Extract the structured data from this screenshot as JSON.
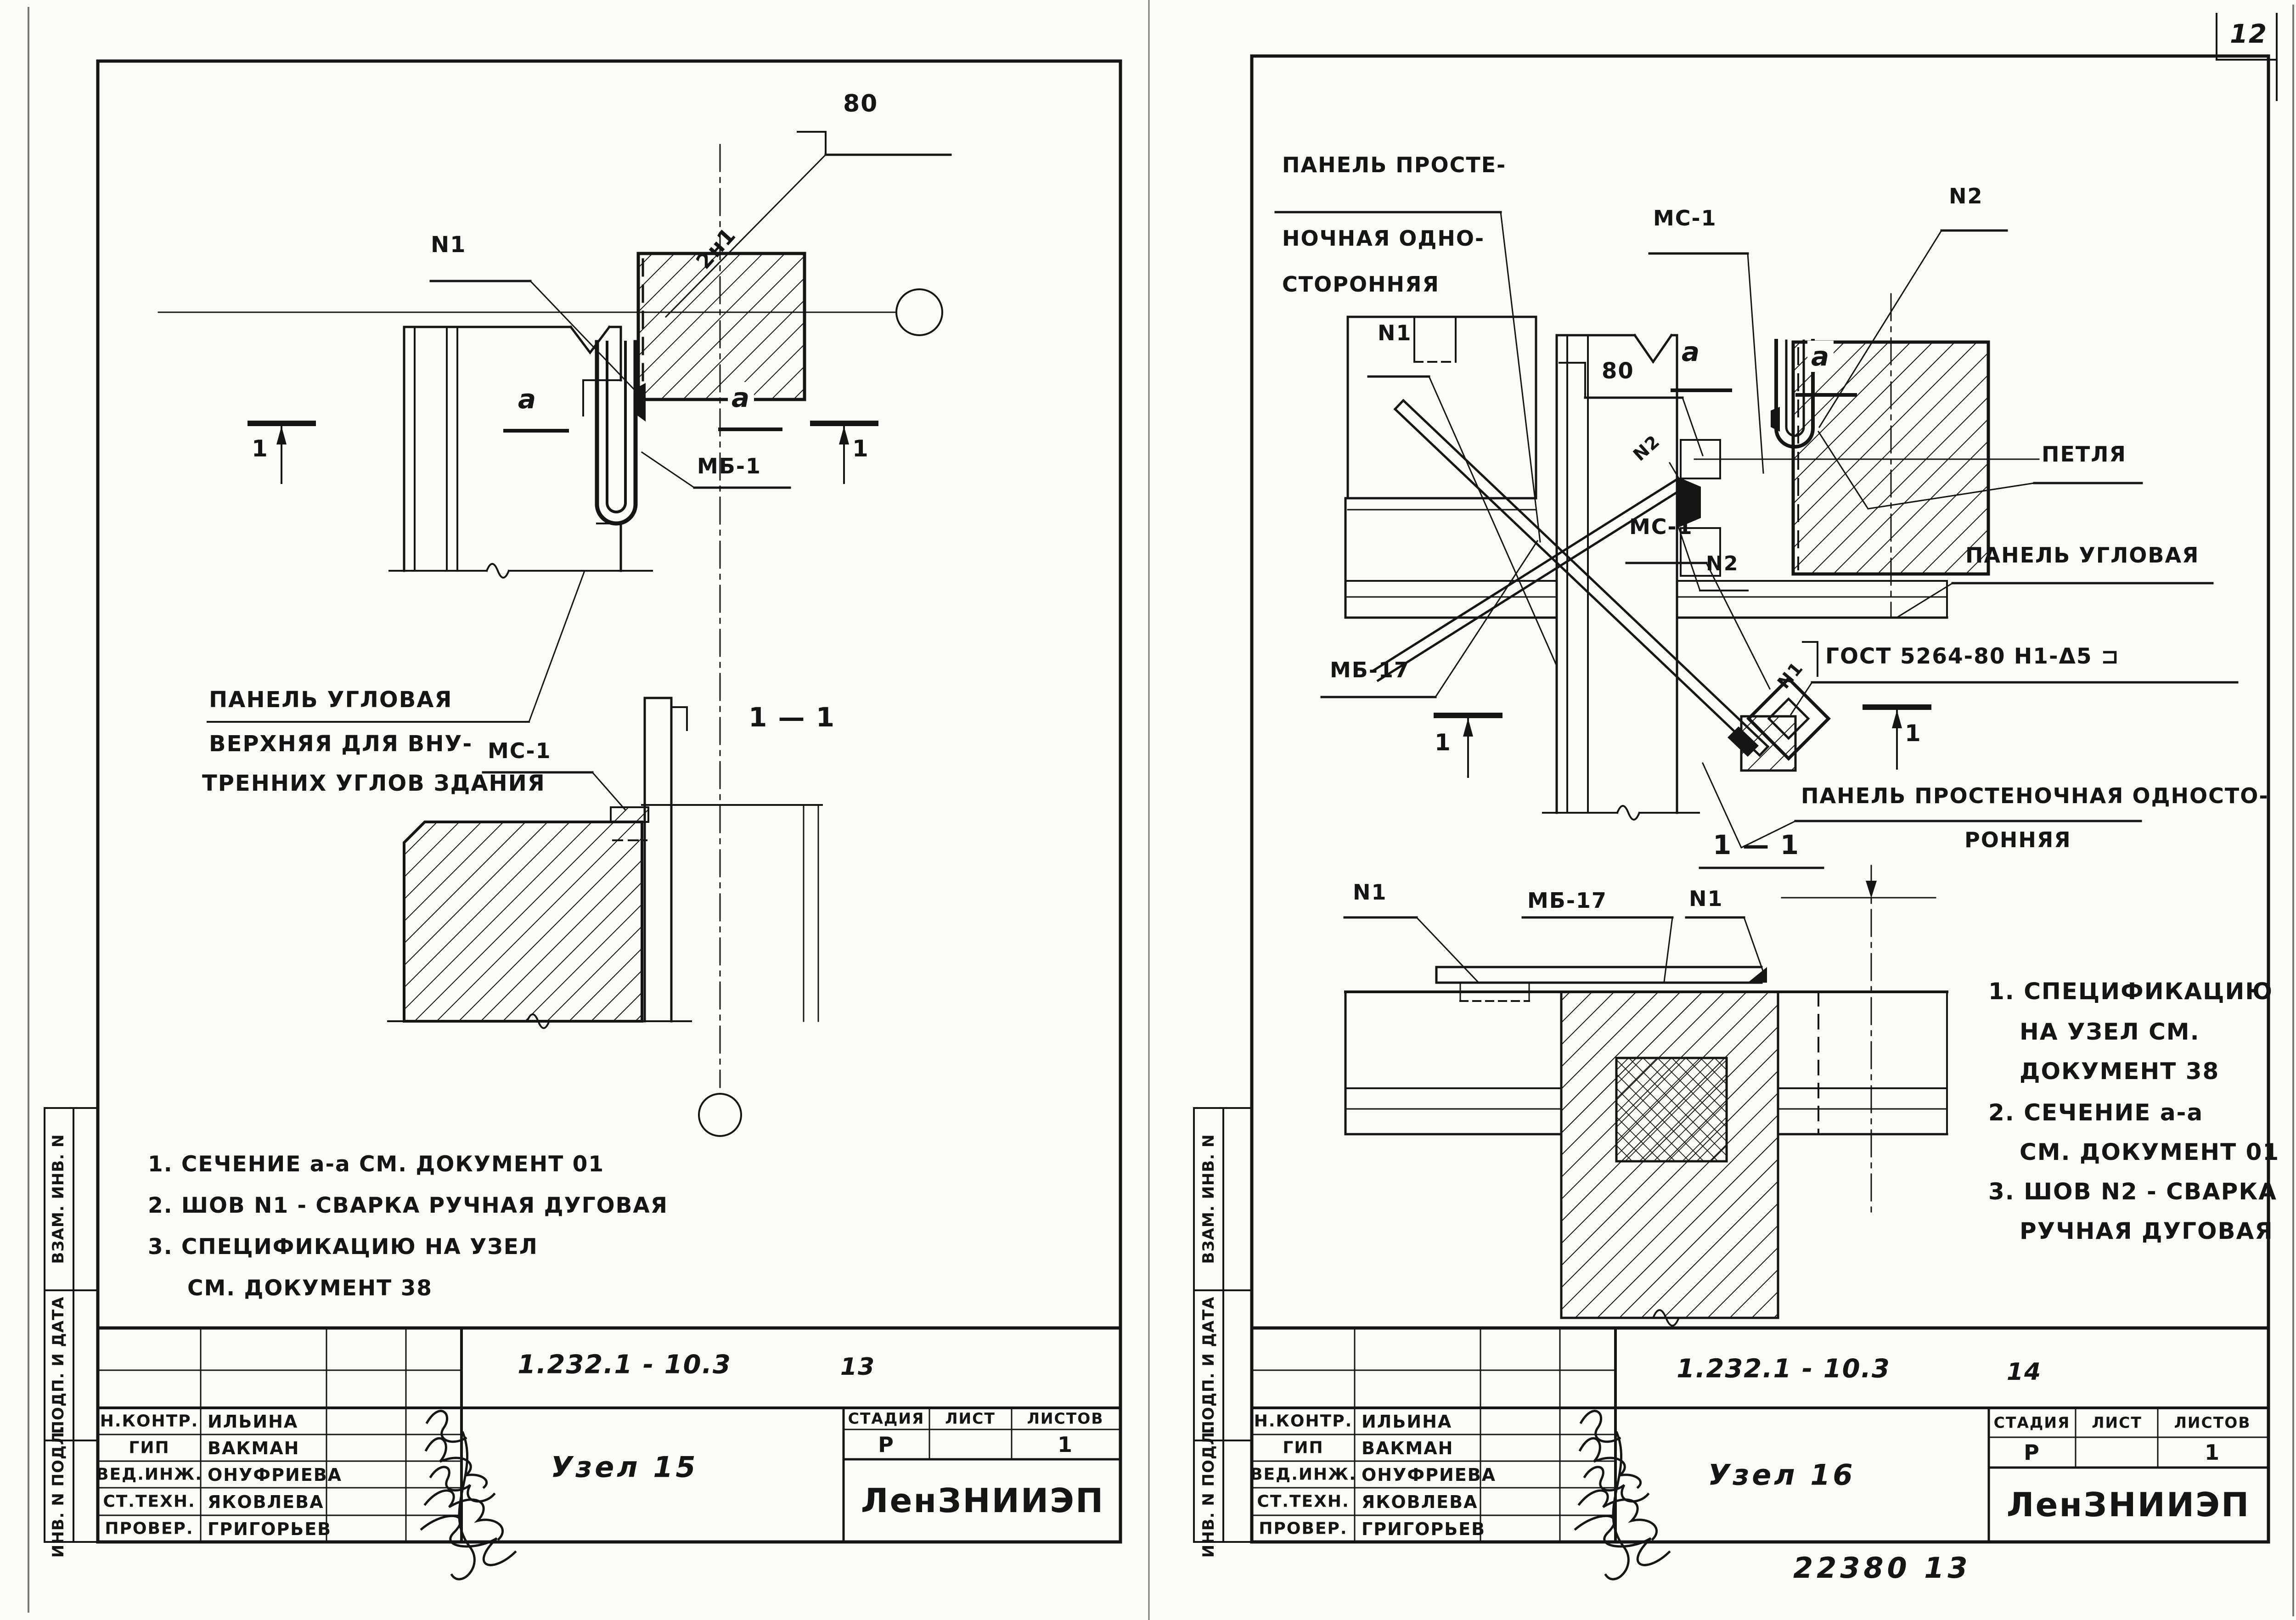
{
  "page": {
    "number": "12",
    "footer_code": "22380 13"
  },
  "staff": [
    {
      "role": "Н.КОНТР.",
      "name": "ИЛЬИНА"
    },
    {
      "role": "ГИП",
      "name": "ВАКМАН"
    },
    {
      "role": "ВЕД.ИНЖ.",
      "name": "ОНУФРИЕВА"
    },
    {
      "role": "СТ.ТЕХН.",
      "name": "ЯКОВЛЕВА"
    },
    {
      "role": "ПРОВЕР.",
      "name": "ГРИГОРЬЕВ"
    }
  ],
  "stamp_headers": {
    "stage": "СТАДИЯ",
    "sheet": "ЛИСТ",
    "sheets": "ЛИСТОВ"
  },
  "side_strip": [
    "ВЗАМ. ИНВ. N",
    "ПОДП. И ДАТА",
    "ИНВ. N ПОДЛ."
  ],
  "left": {
    "doc_code": "1.232.1 - 10.3",
    "sheet_num": "13",
    "node_title": "Узел 15",
    "org": "ЛенЗНИИЭП",
    "stamp": {
      "stage": "Р",
      "sheet": "",
      "sheets": "1"
    },
    "annotations": {
      "n1": "N1",
      "weld_2n1": "2н1",
      "dim_80": "80",
      "a_left": "a",
      "a_right": "a",
      "mb1": "МБ-1",
      "ms1": "МС-1",
      "sec_left": "1",
      "sec_right": "1",
      "sec_title": "1 — 1",
      "panel_cap1": "ПАНЕЛЬ УГЛОВАЯ",
      "panel_cap2": "ВЕРХНЯЯ ДЛЯ ВНУ-",
      "panel_cap3": "ТРЕННИХ УГЛОВ ЗДАНИЯ"
    },
    "notes": [
      "1. СЕЧЕНИЕ a-a СМ. ДОКУМЕНТ 01",
      "2. ШОВ N1 - СВАРКА РУЧНАЯ ДУГОВАЯ",
      "3. СПЕЦИФИКАЦИЮ НА УЗЕЛ",
      "СМ. ДОКУМЕНТ 38"
    ]
  },
  "right": {
    "doc_code": "1.232.1 - 10.3",
    "sheet_num": "14",
    "node_title": "Узел 16",
    "org": "ЛенЗНИИЭП",
    "stamp": {
      "stage": "Р",
      "sheet": "",
      "sheets": "1"
    },
    "annotations": {
      "panel_top1": "ПАНЕЛЬ ПРОСТЕ-",
      "panel_top2": "НОЧНАЯ ОДНО-",
      "panel_top3": "СТОРОННЯЯ",
      "ms1_top": "МС-1",
      "n2_top": "N2",
      "n1": "N1",
      "dim_80": "80",
      "n2_small": "N2",
      "a_left": "a",
      "a_right": "a",
      "ms1_mid": "МС-1",
      "petlya": "ПЕТЛЯ",
      "panel_corner": "ПАНЕЛЬ УГЛОВАЯ",
      "n2_mid": "N2",
      "mb17": "МБ-17",
      "gost_n1": "N1",
      "gost": "ГОСТ 5264-80 Н1-Δ5 ⊐",
      "sec_left": "1",
      "sec_right": "1",
      "panel_bot1": "ПАНЕЛЬ ПРОСТЕНОЧНАЯ ОДНОСТО-",
      "panel_bot2": "РОННЯЯ",
      "sec_title": "1 — 1",
      "s_n1_left": "N1",
      "s_mb17": "МБ-17",
      "s_n1_right": "N1"
    },
    "notes": [
      "1. СПЕЦИФИКАЦИЮ",
      "НА УЗЕЛ СМ.",
      "ДОКУМЕНТ 38",
      "2. СЕЧЕНИЕ a-a",
      "СМ. ДОКУМЕНТ 01",
      "3. ШОВ N2 - СВАРКА",
      "РУЧНАЯ ДУГОВАЯ"
    ]
  }
}
